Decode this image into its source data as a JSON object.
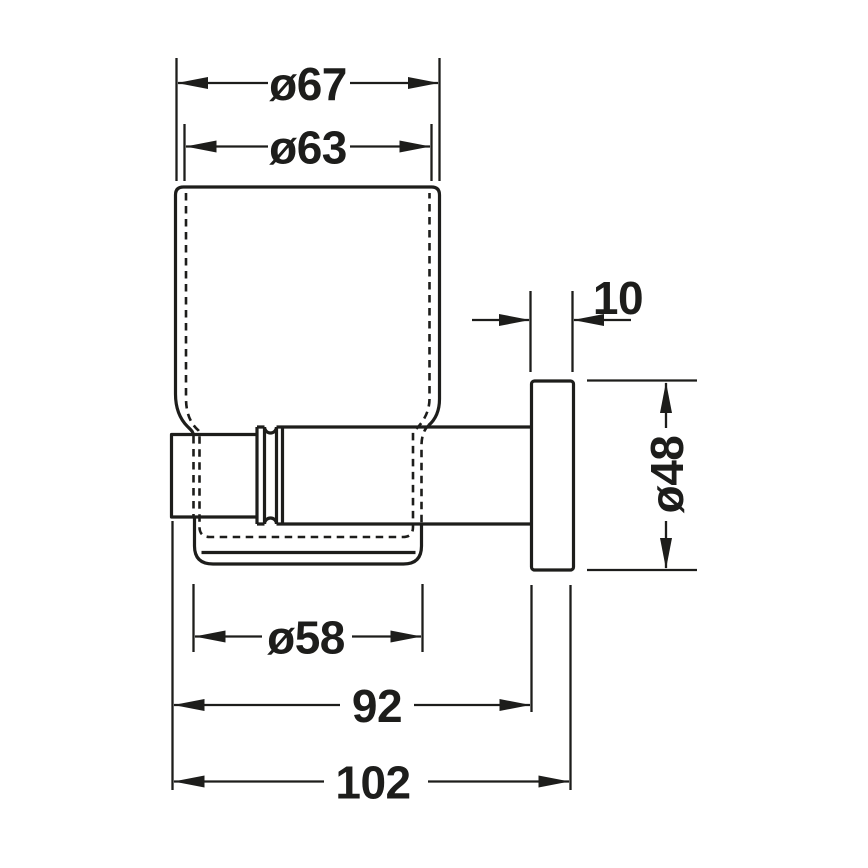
{
  "canvas": {
    "width": 868,
    "height": 868,
    "background": "#ffffff",
    "line_color": "#1d1d1b"
  },
  "drawing": {
    "kind": "technical-dimension-drawing",
    "object": "wall-mounted-glass-tumbler-with-holder"
  },
  "labels": {
    "dia67": "ø67",
    "dia63": "ø63",
    "thickness10": "10",
    "dia48": "ø48",
    "dia58": "ø58",
    "depth92": "92",
    "depth102": "102"
  }
}
